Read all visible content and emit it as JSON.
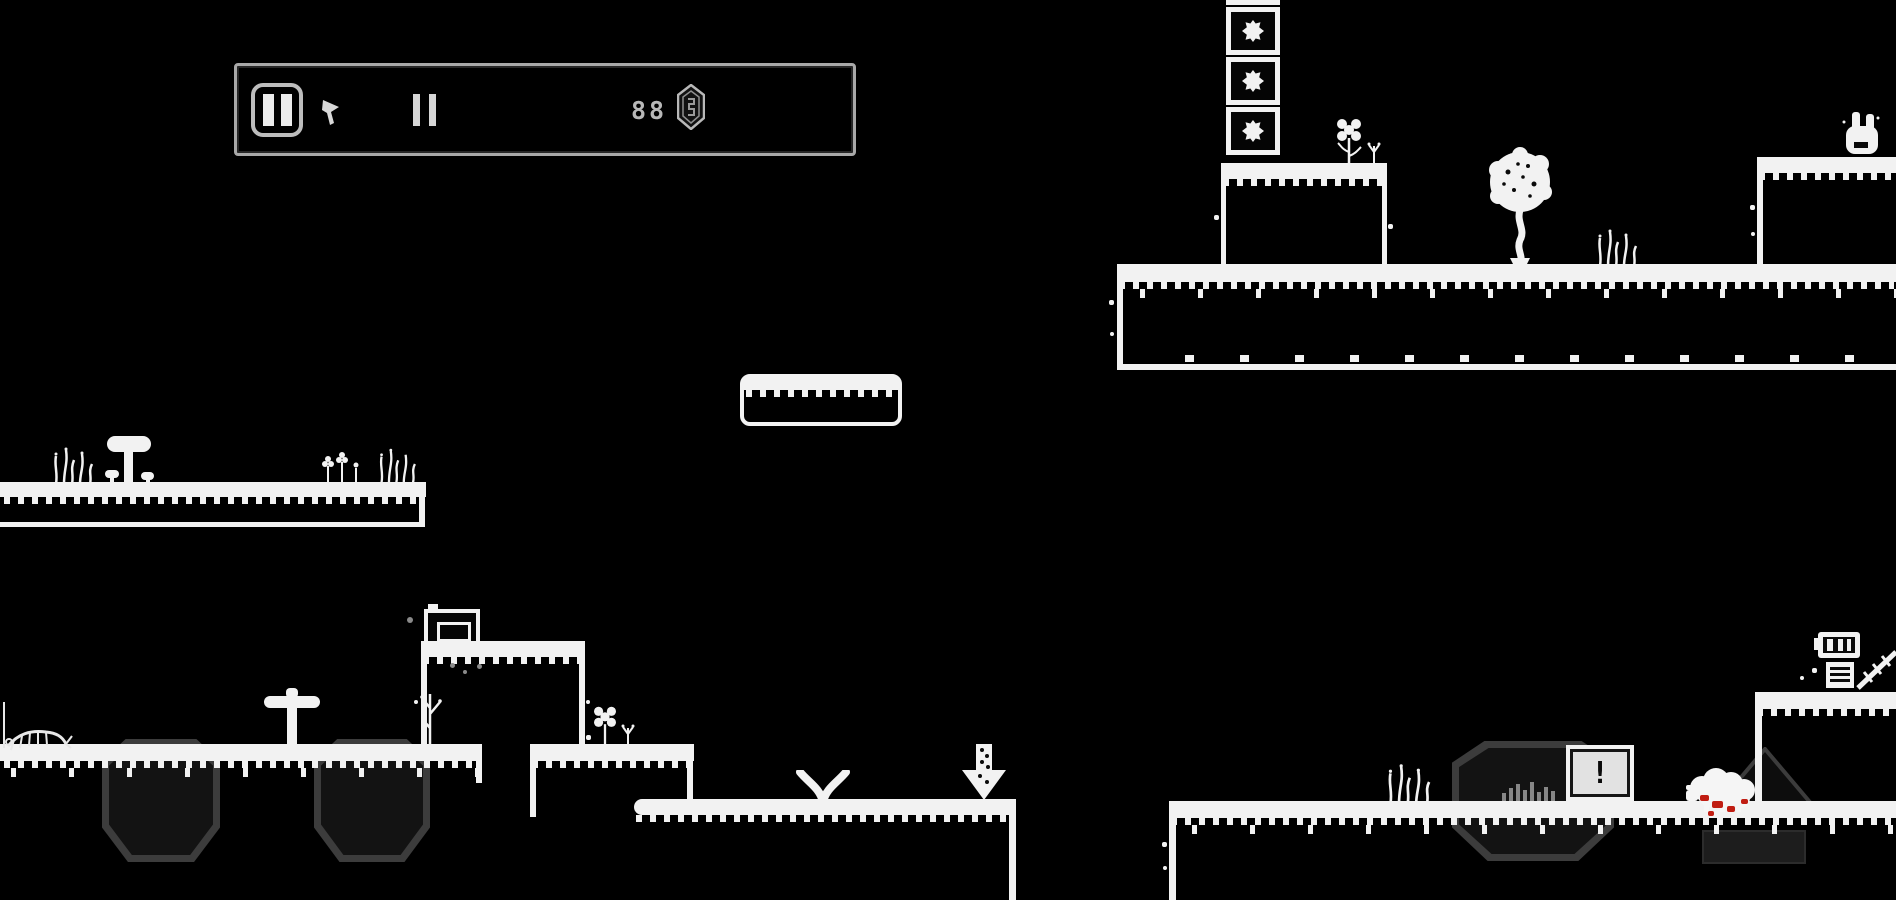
{
  "title": "Monochrome pixel platformer",
  "hud": {
    "pause_button": {
      "label": "pause"
    },
    "counter": {
      "value": "88",
      "unit": "gems"
    }
  },
  "signs": {
    "alert": {
      "label": "!"
    },
    "down_arrow": {
      "label": "down-arrow"
    }
  },
  "world": {
    "crate_count": 3,
    "creatures": [
      "bunny",
      "sheep",
      "robot"
    ],
    "plants": [
      "tree",
      "mushroom",
      "flowers",
      "grass",
      "sprouts",
      "dead-bush"
    ],
    "props": [
      "tv-monitor",
      "alert-sign",
      "down-arrow-sign",
      "dark-crystals",
      "ladder"
    ]
  },
  "colors": {
    "background": "#000000",
    "terrain": "#f2f2f2",
    "dark_shape_outline": "#3c3c3c",
    "dark_shape_fill": "#131313",
    "hud_border": "#a8a8a8",
    "hud_icon": "#cfcfcf",
    "blood": "#c01d12"
  }
}
